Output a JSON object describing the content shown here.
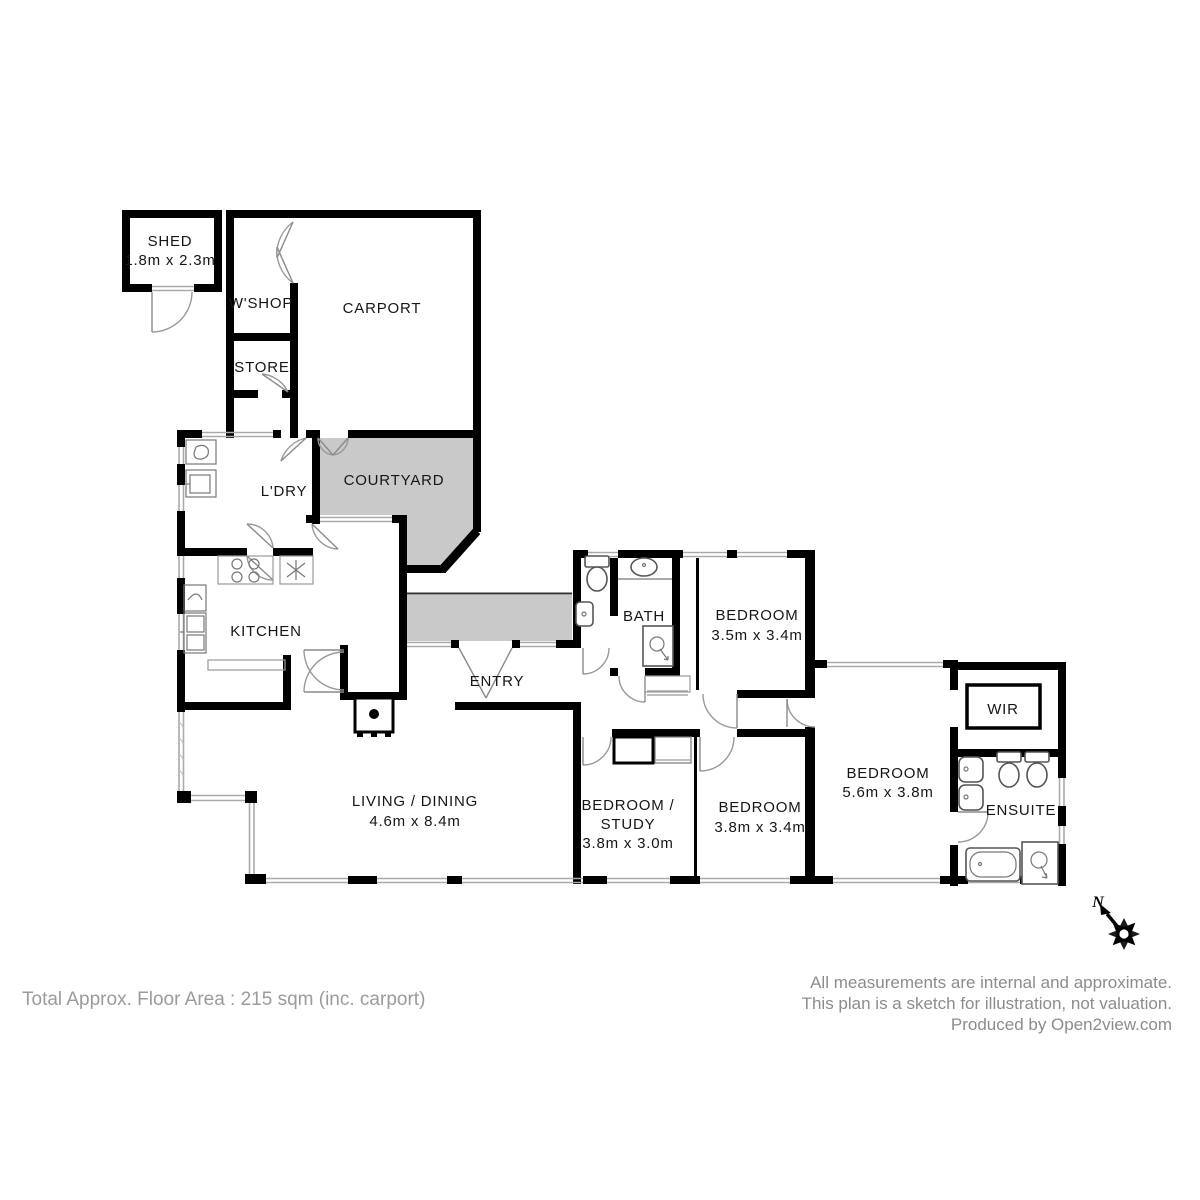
{
  "plan": {
    "rooms": {
      "shed": {
        "name": "SHED",
        "dims": "1.8m x 2.3m"
      },
      "workshop": {
        "name": "W'SHOP"
      },
      "carport": {
        "name": "CARPORT"
      },
      "store": {
        "name": "STORE"
      },
      "laundry": {
        "name": "L'DRY"
      },
      "courtyard": {
        "name": "COURTYARD"
      },
      "kitchen": {
        "name": "KITCHEN"
      },
      "entry": {
        "name": "ENTRY"
      },
      "bath": {
        "name": "BATH"
      },
      "bedroom1": {
        "name": "BEDROOM",
        "dims": "3.5m x 3.4m"
      },
      "wir": {
        "name": "WIR"
      },
      "master_bedroom": {
        "name": "BEDROOM",
        "dims": "5.6m x 3.8m"
      },
      "ensuite": {
        "name": "ENSUITE"
      },
      "living_dining": {
        "name": "LIVING / DINING",
        "dims": "4.6m x 8.4m"
      },
      "bedroom_study": {
        "name_line1": "BEDROOM /",
        "name_line2": "STUDY",
        "dims": "3.8m x 3.0m"
      },
      "bedroom2": {
        "name": "BEDROOM",
        "dims": "3.8m x 3.4m"
      }
    },
    "compass": {
      "north_label": "N"
    },
    "footer": {
      "total_area": "Total Approx. Floor Area : 215 sqm (inc. carport)",
      "disclaimer_line1": "All measurements are internal and approximate.",
      "disclaimer_line2": "This plan is a sketch for illustration, not valuation.",
      "disclaimer_line3": "Produced by Open2view.com"
    },
    "colors": {
      "wall": "#000000",
      "outdoor_area": "#c9c9c9",
      "window_line": "#aaaaaa",
      "door_arc": "#999999",
      "label_text": "#161616",
      "footer_text": "#9b9b9b"
    }
  }
}
